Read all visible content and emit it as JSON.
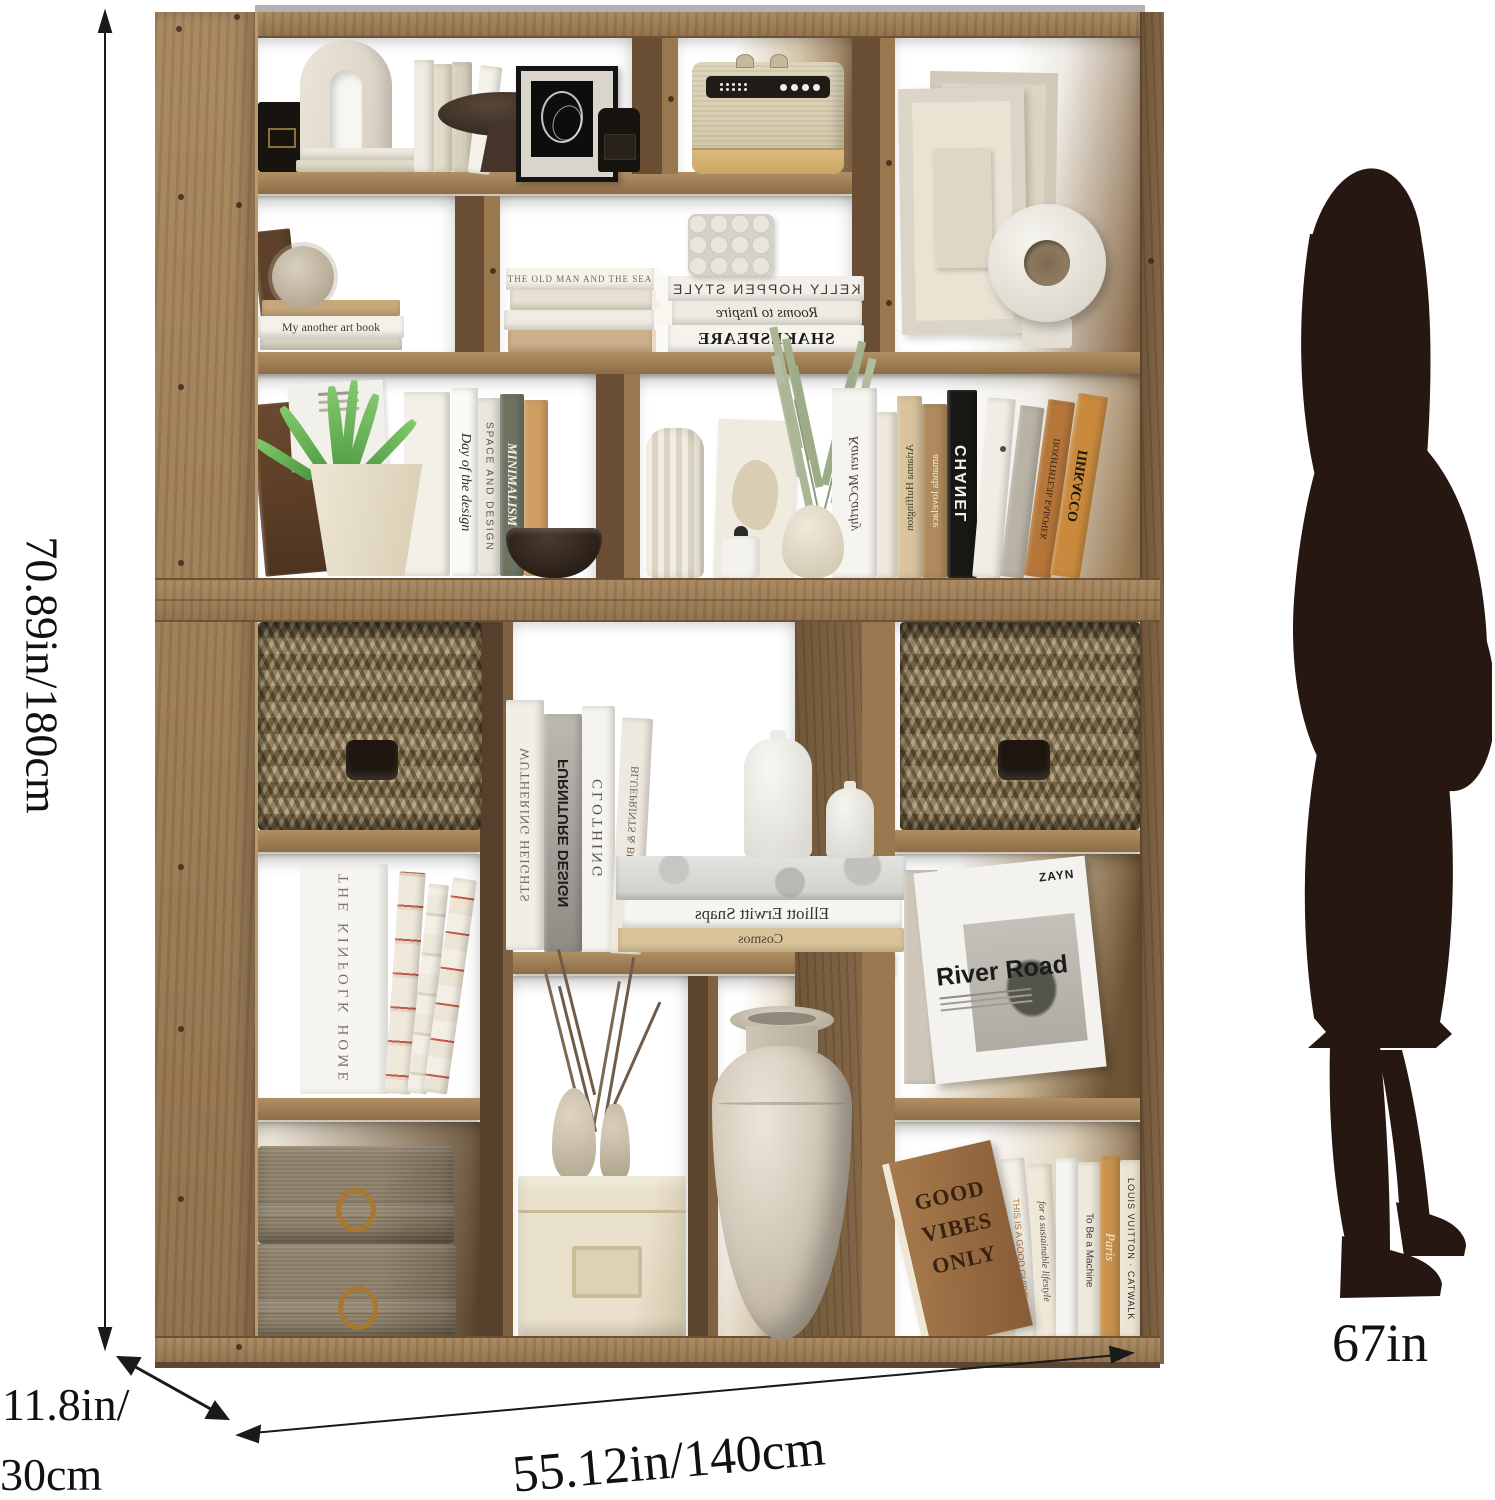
{
  "dimensions": {
    "height": "70.89in/180cm",
    "depth_line1": "11.8in/",
    "depth_line2": "30cm",
    "width": "55.12in/140cm",
    "person_height": "67in"
  },
  "colors": {
    "wood_face": "#9a784f",
    "wood_side": "#6a4e33",
    "silhouette": "#261713",
    "background": "#ffffff",
    "basket": "#8a7454",
    "dimension_text": "#111111"
  },
  "objects": [
    "arch-sculpture",
    "black-candle",
    "pedestal-bowl",
    "framed-line-art",
    "black-jar",
    "vintage-radio",
    "relief-frames",
    "donut-vase",
    "spiky-ball",
    "bubble-candle",
    "aloe-plant",
    "dark-bowl",
    "crinkle-vase",
    "eucalyptus-vase",
    "wicker-basket-left",
    "wicker-basket-right",
    "bottle-vases",
    "dry-branches",
    "weathered-vases",
    "beige-storage-box",
    "large-urn-vase",
    "fabric-boxes",
    "woman-silhouette"
  ],
  "books": {
    "my_another_art_book": "My another art book",
    "old_man_sea": "THE OLD MAN AND THE SEA",
    "kelly_hoppen": "KELLY HOPPEN STYLE",
    "rooms_to_inspire": "Rooms to Inspire",
    "shakespeare": "SHAKESPEARE",
    "day_of_design": "Day of the design",
    "space_and_design": "SPACE AND DESIGN",
    "minimalism": "MINIMALISM",
    "karen_mccarthy": "Karen McCarthy",
    "arianna": "Arianna Huffington",
    "amanda": "amanda lovelace",
    "chanel": "CHANEL",
    "pokhititel": "ПОХИТИТЕЛЬ БАБОЧЕК",
    "picasso": "ПИКАССО",
    "wuthering": "WUTHERING HEIGHTS",
    "furniture_design": "FURNITURE DESIGN",
    "clothing": "CLOTHING",
    "blueprints": "BLUEPRINTS & BUILDINGS",
    "elliott": "Elliott Erwitt Snaps",
    "cosmos": "Cosmos",
    "kinfolk": "THE KINFOLK HOME",
    "river_road": "River Road",
    "river_road_logo": "ZAYN",
    "good_vibes_1": "GOOD",
    "good_vibes_2": "VIBES",
    "good_vibes_3": "ONLY",
    "good_guide": "THIS IS A GOOD GUIDE",
    "sustainable": "for a sustainable lifestyle",
    "to_be_machine": "To Be a Machine",
    "paris": "Paris",
    "louis_vuitton": "LOUIS VUITTON",
    "catwalk": "CATWALK",
    "afterword": "AFTERWORD BY DEEPAK CHOPRA"
  }
}
